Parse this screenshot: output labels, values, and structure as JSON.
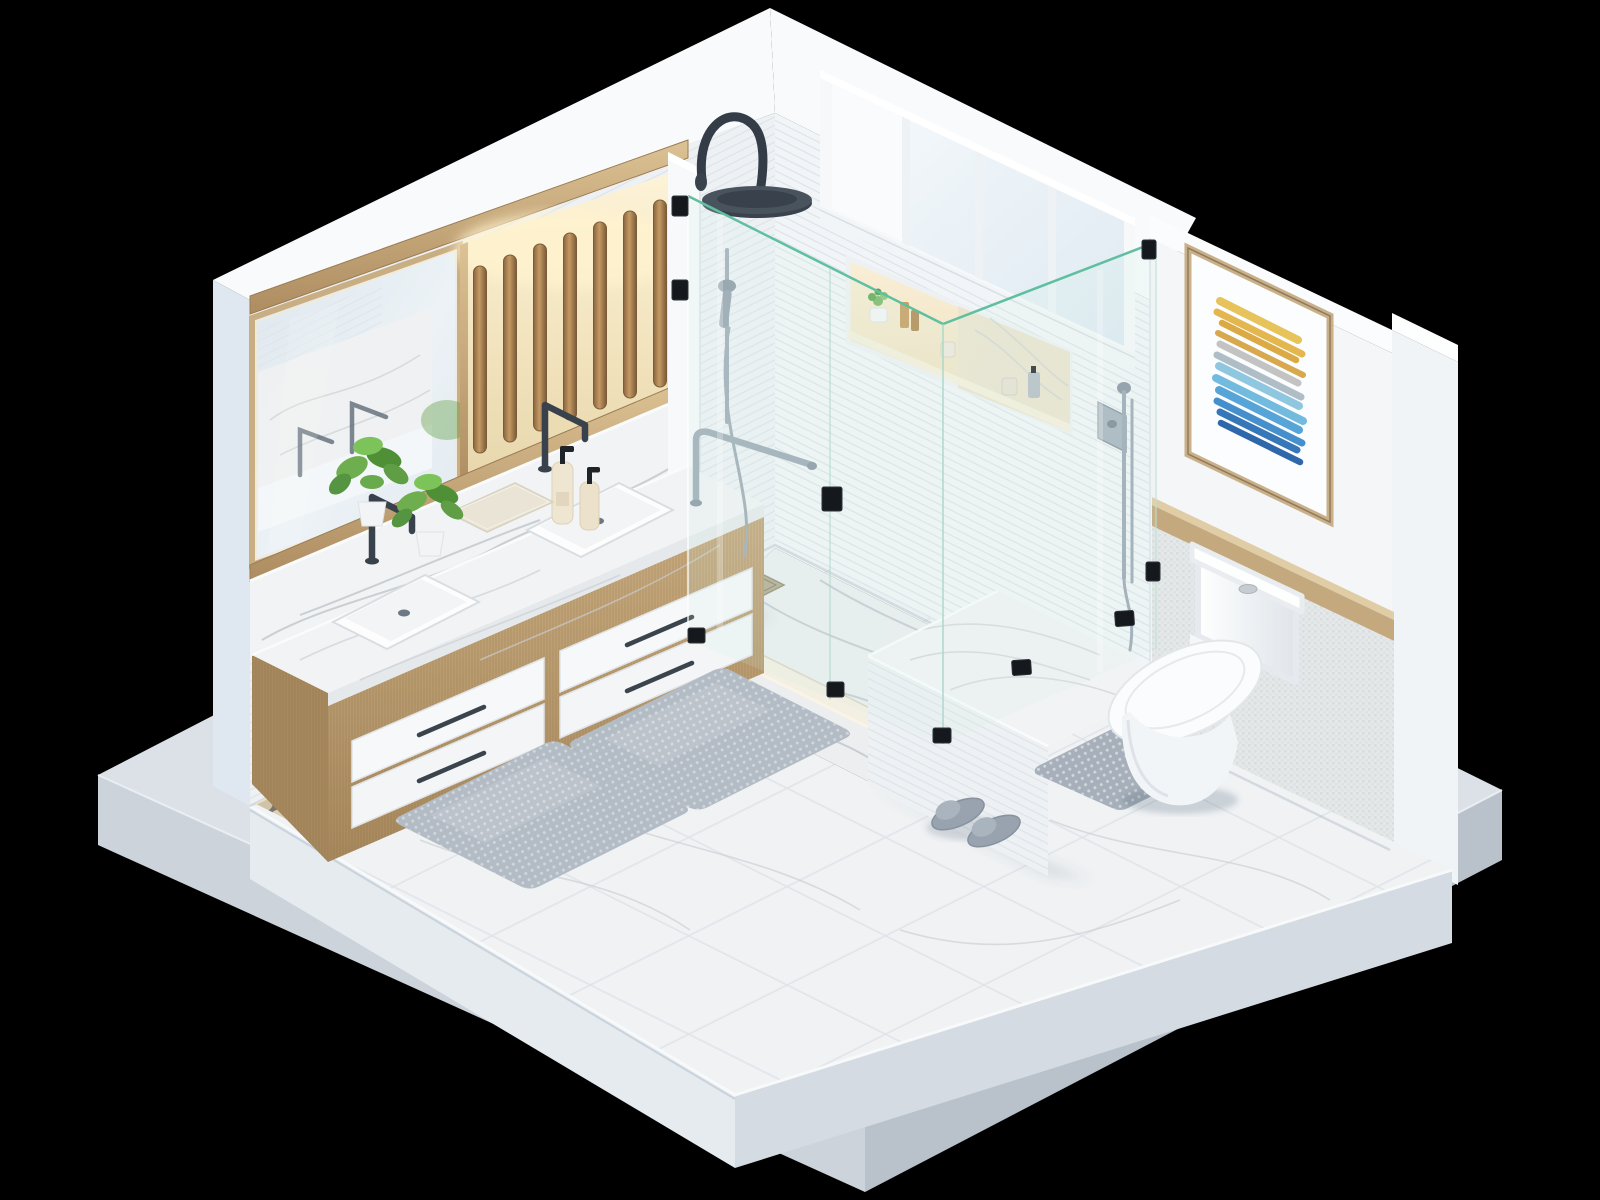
{
  "scene": {
    "title": "Isometric 3D cutaway render of a modern white bathroom on a black background",
    "view": "isometric cutaway diorama, two walls removed, room on a floating concrete base slab",
    "background_color": "#000000",
    "colors": {
      "background": "#000000",
      "wall_left": "#eef1f4",
      "wall_right": "#f2f5f7",
      "wall_accent": "#f4f6f8",
      "wall_cap": "#f8fafc",
      "pillar_left": "#dfe8f0",
      "pillar_right": "#f1f4f7",
      "floor_top": "#f0f2f4",
      "floor_side_left": "#e6ebf0",
      "floor_side_right": "#d4dbe2",
      "base_top": "#dbe1e7",
      "base_side_left": "#ccd3da",
      "base_side_right": "#b9c1ca",
      "wood": "#c2a478",
      "marble": "#f2f3f5",
      "glass_edge": "#5fbfa0",
      "fixture_dark": "#39424c",
      "chrome": "#9fabb6",
      "warm_light": "#f6ecd2",
      "mat_gray": "#b3bbc4",
      "toilet_white": "#fbfcfd",
      "plant_green": "#5f9e44",
      "bottle_cream": "#efe6d2",
      "art_frame": "#c9b089"
    },
    "objects": [
      {
        "id": "display-base",
        "label": "concrete display base slab"
      },
      {
        "id": "floor",
        "label": "white stone tile floor slab"
      },
      {
        "id": "back-left-wall",
        "label": "white striped-tile wall with vanity area"
      },
      {
        "id": "back-right-wall",
        "label": "white striped-tile wall with window and shower niche"
      },
      {
        "id": "accent-wall",
        "label": "right wall panel with framed art, wood ledge and mosaic wainscot"
      },
      {
        "id": "mirror",
        "label": "wide wood-framed vanity mirror with reflections"
      },
      {
        "id": "slat-panel",
        "label": "backlit vertical wood slat feature panel",
        "slat_count": 7
      },
      {
        "id": "vanity",
        "label": "floating oak double vanity with white drawers",
        "drawer_count": 4
      },
      {
        "id": "countertop",
        "label": "white marble countertop with two undermount sinks"
      },
      {
        "id": "faucets",
        "label": "two dark gunmetal deck-mounted faucets"
      },
      {
        "id": "plants",
        "label": "two green potted plants on counter"
      },
      {
        "id": "soap-bottles",
        "label": "two cream soap dispensers with black pumps"
      },
      {
        "id": "towel",
        "label": "folded waffle hand towel"
      },
      {
        "id": "pebble-border",
        "label": "river pebble border with warm accent lighting"
      },
      {
        "id": "shower",
        "label": "corner walk-in shower with green-edged glass enclosure"
      },
      {
        "id": "rain-shower",
        "label": "dark gooseneck rainfall shower head"
      },
      {
        "id": "hand-shower",
        "label": "chrome handheld shower on slide bar"
      },
      {
        "id": "grab-bar",
        "label": "chrome grab bar on partition"
      },
      {
        "id": "shower-valve",
        "label": "chrome shower valve with hand wand near niche"
      },
      {
        "id": "shower-bench",
        "label": "tiled shower bench with marble top"
      },
      {
        "id": "shower-niche",
        "label": "recessed lit niche with toiletries",
        "items": [
          "succulent in white pot",
          "tan bottle",
          "amber bottle",
          "white jar",
          "white jar",
          "grey pump bottle"
        ]
      },
      {
        "id": "window",
        "label": "clerestory window",
        "pane_count": 4
      },
      {
        "id": "framed-art",
        "label": "abstract brushstroke artwork in wood frame"
      },
      {
        "id": "wood-ledge",
        "label": "wood picture ledge"
      },
      {
        "id": "toilet",
        "label": "white two-piece toilet"
      },
      {
        "id": "bath-mats",
        "label": "two grey textured bath mats"
      },
      {
        "id": "toilet-mat",
        "label": "grey contour mat under toilet"
      },
      {
        "id": "slippers",
        "label": "pair of grey slippers"
      },
      {
        "id": "floor-drain",
        "label": "square brass floor drain in shower"
      }
    ],
    "art": {
      "stroke_colors": [
        "#e7c35b",
        "#e3b64e",
        "#dcaa45",
        "#d8a84e",
        "#c2c3c2",
        "#aebdc6",
        "#8fc7e0",
        "#72bbdf",
        "#57a5d8",
        "#4590cc",
        "#3577b8",
        "#2e67aa"
      ],
      "frame_color": "#c9b089",
      "mat_color": "#fcfdfe"
    }
  }
}
